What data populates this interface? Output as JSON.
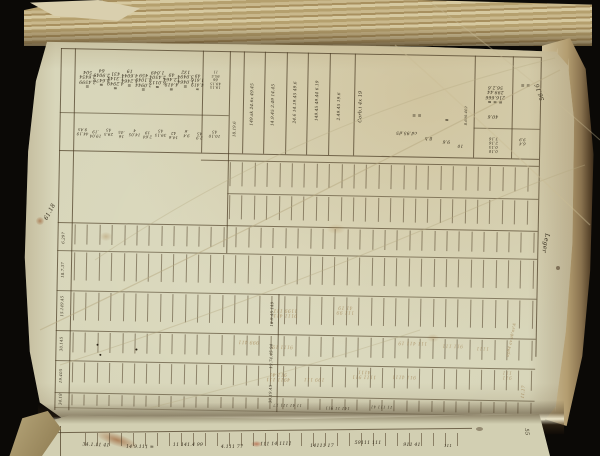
{
  "document": {
    "kind": "manuscript-ledger-photograph",
    "page_number": "1"
  },
  "palette": {
    "ink": "#342c1c",
    "faded": "#96723f",
    "line": "#4b3c24",
    "page": "#d8d6ba",
    "foredge": "#c3b084",
    "backdrop": "#0b0906"
  },
  "annotations": {
    "top_right_margin": "56.16",
    "right_margin": "Leger",
    "left_margin": "61.18",
    "bottom_right_faded": "11.17",
    "next_page_right": "55"
  },
  "handwriting": {
    "note": "illegible 18th-century style numeric entries, page photographed rotated",
    "clusters": [
      {
        "l": "sheet",
        "x": 30,
        "y": 32,
        "r": 180,
        "s": 6,
        "sc": 0.75,
        "t": "≡\n2.4599\n2.6454\n504"
      },
      {
        "l": "sheet",
        "x": 44,
        "y": 30,
        "r": 180,
        "s": 6,
        "sc": 0.75,
        "t": "≡\n8.6479\n2.9049\n64"
      },
      {
        "l": "sheet",
        "x": 58,
        "y": 33,
        "r": 180,
        "s": 6,
        "sc": 0.75,
        "t": "≡\n4.2949\n1.3144\n431"
      },
      {
        "l": "sheet",
        "x": 72,
        "y": 30,
        "r": 180,
        "s": 6,
        "sc": 0.75,
        "t": "≡\n1.2464\n4.6044\n19"
      },
      {
        "l": "sheet",
        "x": 86,
        "y": 34,
        "r": 180,
        "s": 6,
        "sc": 0.75,
        "t": "≡\n2.0944\n4.1049\n459"
      },
      {
        "l": "sheet",
        "x": 100,
        "y": 31,
        "r": 180,
        "s": 6,
        "sc": 0.75,
        "t": "≡\n6.0113\n2.4504\n1.049"
      },
      {
        "l": "sheet",
        "x": 114,
        "y": 33,
        "r": 180,
        "s": 6,
        "sc": 0.75,
        "t": "≡\n4.419\n12.464\n49"
      },
      {
        "l": "sheet",
        "x": 128,
        "y": 30,
        "r": 180,
        "s": 6,
        "sc": 0.75,
        "t": "≡\n1.0464\n3.0494\n132"
      },
      {
        "l": "sheet",
        "x": 140,
        "y": 33,
        "r": 180,
        "s": 6,
        "sc": 0.7,
        "t": "≡\n4.419\n1.616\n49"
      },
      {
        "l": "sheet",
        "x": 158,
        "y": 30,
        "r": 180,
        "s": 5,
        "sc": 0.7,
        "t": "19.15\n49.15\n66\n95.5\n11"
      },
      {
        "l": "sheet",
        "x": 26,
        "y": 84,
        "r": 180,
        "s": 5.5,
        "sc": 0.7,
        "t": "44.19\n9.45"
      },
      {
        "l": "sheet",
        "x": 39,
        "y": 86,
        "r": 180,
        "s": 5.5,
        "sc": 0.7,
        "t": "19.04\n.19"
      },
      {
        "l": "sheet",
        "x": 52,
        "y": 84,
        "r": 180,
        "s": 5.5,
        "sc": 0.7,
        "t": "29.5\n45"
      },
      {
        "l": "sheet",
        "x": 65,
        "y": 86,
        "r": 180,
        "s": 5.5,
        "sc": 0.7,
        "t": "16\n.45"
      },
      {
        "l": "sheet",
        "x": 78,
        "y": 84,
        "r": 180,
        "s": 5.5,
        "sc": 0.7,
        "t": "14.05\n4"
      },
      {
        "l": "sheet",
        "x": 91,
        "y": 86,
        "r": 180,
        "s": 5.5,
        "sc": 0.7,
        "t": "2.64\n19"
      },
      {
        "l": "sheet",
        "x": 104,
        "y": 84,
        "r": 180,
        "s": 5.5,
        "sc": 0.7,
        "t": "39.15\n45"
      },
      {
        "l": "sheet",
        "x": 117,
        "y": 86,
        "r": 180,
        "s": 5.5,
        "sc": 0.7,
        "t": "14.6\n42"
      },
      {
        "l": "sheet",
        "x": 130,
        "y": 84,
        "r": 180,
        "s": 5.5,
        "sc": 0.7,
        "t": "9.4\n.6"
      },
      {
        "l": "sheet",
        "x": 143,
        "y": 86,
        "r": 180,
        "s": 5.5,
        "sc": 0.7,
        "t": "2.9\n45"
      },
      {
        "l": "sheet",
        "x": 158,
        "y": 84,
        "r": 180,
        "s": 5.5,
        "sc": 0.7,
        "t": "10.10\n45"
      },
      {
        "l": "sheet",
        "x": 179,
        "y": 80,
        "r": "v",
        "h": 40,
        "s": 5.5,
        "sc": 0.7,
        "t": "18.19.6"
      },
      {
        "l": "sheet",
        "x": 196,
        "y": 55,
        "r": "v",
        "h": 90,
        "s": 5.5,
        "sc": 0.75,
        "t": "149.sk 24.6x 49.45"
      },
      {
        "l": "sheet",
        "x": 217,
        "y": 55,
        "r": "v",
        "h": 90,
        "s": 5.5,
        "sc": 0.75,
        "t": "14.9.45 2.49 14.45"
      },
      {
        "l": "sheet",
        "x": 239,
        "y": 52,
        "r": "v",
        "h": 88,
        "s": 5.5,
        "sc": 0.75,
        "t": "24.6 14.19.45 49.6"
      },
      {
        "l": "sheet",
        "x": 261,
        "y": 50,
        "r": "v",
        "h": 88,
        "s": 5.5,
        "sc": 0.75,
        "t": "149.45 49.44 6.19"
      },
      {
        "l": "sheet",
        "x": 283,
        "y": 55,
        "r": "v",
        "h": 80,
        "s": 5.5,
        "sc": 0.75,
        "t": "2.49.45 19.6"
      },
      {
        "l": "sheet",
        "x": 304,
        "y": 55,
        "r": "v",
        "h": 70,
        "s": 6,
        "sc": 0.8,
        "t": "Corb.i 4x 19"
      },
      {
        "l": "sheet",
        "x": 350,
        "y": 80,
        "r": 180,
        "s": 6,
        "sc": 0.75,
        "t": "cd.95.d5"
      },
      {
        "l": "sheet",
        "x": 360,
        "y": 62,
        "r": 180,
        "s": 6,
        "sc": 0.75,
        "t": "≡ ≡"
      },
      {
        "l": "sheet",
        "x": 372,
        "y": 85,
        "r": 180,
        "s": 6,
        "sc": 0.75,
        "t": "8.b"
      },
      {
        "l": "sheet",
        "x": 390,
        "y": 66,
        "r": 180,
        "s": 6,
        "sc": 0.75,
        "t": "≡"
      },
      {
        "l": "sheet",
        "x": 390,
        "y": 88,
        "r": 180,
        "s": 6,
        "sc": 0.75,
        "t": "9.6"
      },
      {
        "l": "sheet",
        "x": 404,
        "y": 92,
        "r": 180,
        "s": 6,
        "sc": 0.7,
        "t": "10"
      },
      {
        "l": "sheet",
        "x": 410,
        "y": 62,
        "r": "v",
        "h": 58,
        "s": 5,
        "sc": 0.7,
        "t": "8.600.469"
      },
      {
        "l": "sheet",
        "x": 438,
        "y": 40,
        "r": 180,
        "s": 6,
        "sc": 0.75,
        "t": "≡ ≡ ≡\n216.666\n299.44\n56.2.6"
      },
      {
        "l": "sheet",
        "x": 436,
        "y": 62,
        "r": 180,
        "s": 6,
        "sc": 0.75,
        "t": "40.6"
      },
      {
        "l": "sheet",
        "x": 468,
        "y": 30,
        "r": 180,
        "s": 6,
        "sc": 0.75,
        "t": "≡ ≡"
      },
      {
        "l": "sheet",
        "x": 437,
        "y": 90,
        "r": 180,
        "s": 5.5,
        "sc": 0.7,
        "t": "0.10\n0.15\n2.16\n3.16"
      },
      {
        "l": "sheet",
        "x": 466,
        "y": 86,
        "r": 180,
        "s": 5.5,
        "sc": 0.7,
        "t": "6.4\n9.9"
      },
      {
        "l": "sheet",
        "x": 10,
        "y": 192,
        "r": "v",
        "h": 30,
        "s": 5.5,
        "sc": 0.7,
        "t": "6.297"
      },
      {
        "l": "sheet",
        "x": 10,
        "y": 224,
        "r": "v",
        "h": 30,
        "s": 5.5,
        "sc": 0.7,
        "t": "18.7.37"
      },
      {
        "l": "sheet",
        "x": 10,
        "y": 260,
        "r": "v",
        "h": 36,
        "s": 5.5,
        "sc": 0.7,
        "t": "15.149.45"
      },
      {
        "l": "sheet",
        "x": 10,
        "y": 298,
        "r": "v",
        "h": 30,
        "s": 5.5,
        "sc": 0.7,
        "t": "30.145"
      },
      {
        "l": "sheet",
        "x": 10,
        "y": 330,
        "r": "v",
        "h": 28,
        "s": 5.5,
        "sc": 0.7,
        "t": "19.405"
      },
      {
        "l": "sheet",
        "x": 10,
        "y": 354,
        "r": "v",
        "h": 14,
        "s": 5.5,
        "sc": 0.7,
        "t": "34.18"
      },
      {
        "l": "sheet",
        "x": 220,
        "y": 264,
        "r": "v",
        "h": 38,
        "s": 5.5,
        "sc": 0.7,
        "t": "18.9.45 149"
      },
      {
        "l": "sheet",
        "x": 220,
        "y": 306,
        "r": "v",
        "h": 38,
        "s": 5.5,
        "sc": 0.7,
        "t": "19.74.45 94"
      },
      {
        "l": "sheet",
        "x": 220,
        "y": 344,
        "r": "v",
        "h": 30,
        "s": 5.5,
        "sc": 0.7,
        "t": "30.19.45"
      },
      {
        "l": "sheet",
        "x": 232,
        "y": 262,
        "r": 180,
        "s": 6,
        "sc": 0.8,
        "c": "faded",
        "o": 0.6,
        "t": "9111 411\n1199 111"
      },
      {
        "l": "sheet",
        "x": 292,
        "y": 258,
        "r": 180,
        "s": 6,
        "sc": 0.8,
        "c": "faded",
        "o": 0.55,
        "t": "111 99\n41 19"
      },
      {
        "l": "sheet",
        "x": 196,
        "y": 292,
        "r": 180,
        "s": 6,
        "sc": 0.8,
        "c": "faded",
        "o": 0.6,
        "t": "999 411"
      },
      {
        "l": "sheet",
        "x": 230,
        "y": 296,
        "r": 180,
        "s": 6,
        "sc": 0.8,
        "c": "faded",
        "o": 0.55,
        "t": "9111 19"
      },
      {
        "l": "sheet",
        "x": 312,
        "y": 322,
        "r": 180,
        "s": 6,
        "sc": 0.8,
        "c": "faded",
        "o": 0.6,
        "t": "1111 911\n4111"
      },
      {
        "l": "sheet",
        "x": 226,
        "y": 326,
        "r": 180,
        "s": 6,
        "sc": 0.8,
        "c": "faded",
        "o": 0.65,
        "t": "4911 111\n911 41"
      },
      {
        "l": "sheet",
        "x": 262,
        "y": 328,
        "r": 180,
        "s": 6,
        "sc": 0.8,
        "c": "faded",
        "o": 0.55,
        "t": "199 111"
      },
      {
        "l": "sheet",
        "x": 360,
        "y": 290,
        "r": 180,
        "s": 6,
        "sc": 0.8,
        "c": "faded",
        "o": 0.55,
        "t": "111 411 19"
      },
      {
        "l": "sheet",
        "x": 400,
        "y": 292,
        "r": 180,
        "s": 6,
        "sc": 0.8,
        "c": "faded",
        "o": 0.5,
        "t": "911 111"
      },
      {
        "l": "sheet",
        "x": 430,
        "y": 294,
        "r": 180,
        "s": 6,
        "sc": 0.8,
        "c": "faded",
        "o": 0.5,
        "t": "1111"
      },
      {
        "l": "sheet",
        "x": 352,
        "y": 324,
        "r": 180,
        "s": 6,
        "sc": 0.8,
        "c": "faded",
        "o": 0.55,
        "t": "911 4111"
      },
      {
        "l": "sheet",
        "x": 455,
        "y": 320,
        "r": 180,
        "s": 6,
        "sc": 0.8,
        "c": "faded",
        "o": 0.5,
        "t": "911\n111"
      },
      {
        "l": "sheet",
        "x": 236,
        "y": 354,
        "r": 180,
        "s": 5,
        "sc": 0.8,
        "o": 0.8,
        "t": "11 41 111 17"
      },
      {
        "l": "sheet",
        "x": 286,
        "y": 356,
        "r": 180,
        "s": 5,
        "sc": 0.8,
        "o": 0.8,
        "t": "141 11 911"
      },
      {
        "l": "sheet",
        "x": 330,
        "y": 354,
        "r": 180,
        "s": 5,
        "sc": 0.8,
        "o": 0.8,
        "t": "11 111 41"
      },
      {
        "l": "page",
        "x": 540,
        "y": 92,
        "r": 250,
        "s": 6.5,
        "sc": 0.9,
        "t": "56.16"
      },
      {
        "l": "page",
        "x": 545,
        "y": 243,
        "r": 100,
        "s": 7,
        "sc": 0.9,
        "t": "Leger"
      },
      {
        "l": "page",
        "x": 50,
        "y": 212,
        "r": -62,
        "s": 6.5,
        "sc": 0.9,
        "t": "61.18"
      },
      {
        "l": "page",
        "x": 524,
        "y": 392,
        "r": -85,
        "s": 5,
        "sc": 0.85,
        "c": "faded",
        "o": 0.8,
        "t": "11.17"
      },
      {
        "l": "page",
        "x": 512,
        "y": 340,
        "r": -78,
        "s": 5,
        "sc": 0.8,
        "c": "faded",
        "o": 0.7,
        "t": "ap94 av ab'av'A"
      },
      {
        "l": "next",
        "x": 96,
        "y": 446,
        "r": 2,
        "s": 5.5,
        "sc": 0.85,
        "t": "34.1.11 41"
      },
      {
        "l": "next",
        "x": 140,
        "y": 448,
        "r": 1,
        "s": 5.5,
        "sc": 0.85,
        "t": "14 9.111 ≡"
      },
      {
        "l": "next",
        "x": 188,
        "y": 446,
        "r": 0,
        "s": 5.5,
        "sc": 0.85,
        "t": "11 141.4 99"
      },
      {
        "l": "next",
        "x": 232,
        "y": 448,
        "r": 0,
        "s": 5.5,
        "sc": 0.85,
        "t": "4.111 77"
      },
      {
        "l": "next",
        "x": 276,
        "y": 445,
        "r": -1,
        "s": 5.5,
        "sc": 0.85,
        "t": "111 14 1111"
      },
      {
        "l": "next",
        "x": 322,
        "y": 447,
        "r": 0,
        "s": 5.5,
        "sc": 0.85,
        "t": "14111 17"
      },
      {
        "l": "next",
        "x": 368,
        "y": 444,
        "r": 0,
        "s": 5.5,
        "sc": 0.85,
        "t": "59111 111"
      },
      {
        "l": "next",
        "x": 412,
        "y": 446,
        "r": 0,
        "s": 5.5,
        "sc": 0.85,
        "t": "911 41"
      },
      {
        "l": "next",
        "x": 448,
        "y": 447,
        "r": 0,
        "s": 5,
        "sc": 0.8,
        "t": "111"
      },
      {
        "l": "next",
        "x": 526,
        "y": 432,
        "r": 85,
        "s": 6,
        "sc": 0.9,
        "t": "55"
      }
    ]
  }
}
